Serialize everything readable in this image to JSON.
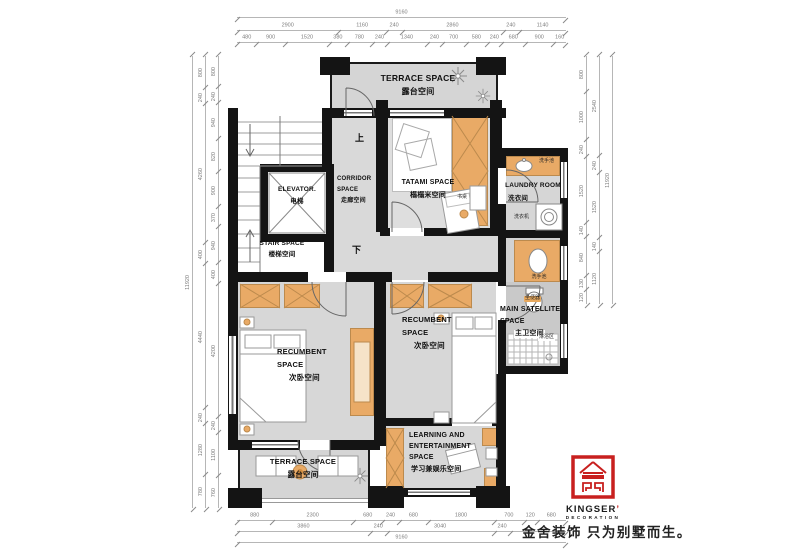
{
  "rooms": {
    "terrace_top": {
      "en": "TERRACE SPACE",
      "cn": "露台空间"
    },
    "corridor": {
      "en1": "CORRIDOR",
      "en2": "SPACE",
      "cn": "走廊空间"
    },
    "elevator": {
      "en": "ELEVATOR.",
      "cn": "电梯"
    },
    "stair": {
      "en": "STAIR SPACE",
      "cn": "楼梯空间"
    },
    "tatami": {
      "en": "TATAMI SPACE",
      "cn": "榻榻米空间"
    },
    "laundry": {
      "en": "LAUNDRY ROOM",
      "cn": "洗衣间"
    },
    "main_bath": {
      "en1": "MAIN SATELLITE",
      "en2": "SPACE",
      "cn": "主卫空间"
    },
    "bed_left": {
      "en1": "RECUMBENT",
      "en2": "SPACE",
      "cn": "次卧空间"
    },
    "bed_right": {
      "en1": "RECUMBENT",
      "en2": "SPACE",
      "cn": "次卧空间"
    },
    "learning": {
      "en1": "LEARNING AND",
      "en2": "ENTERTAINMENT",
      "en3": "SPACE",
      "cn": "学习兼娱乐空间"
    },
    "terrace_bottom": {
      "en": "TERRACE SPACE",
      "cn": "露台空间"
    }
  },
  "annotations": {
    "up": "上",
    "down": "下",
    "basin_laundry": "洗手池",
    "basin_bath": "洗手池",
    "washer": "洗衣机",
    "toilet": "坐便器",
    "shower": "淋浴区",
    "desk": "书桌"
  },
  "logo": {
    "brand": "KINGSER",
    "mark": "’",
    "sub": "DECORATION",
    "tagline": "金舍装饰 只为别墅而生。",
    "red": "#c8201f"
  },
  "colors": {
    "wall": "#141414",
    "floor": "#d8d8d8",
    "furniture": "#e9aa66",
    "logo_red": "#c8201f"
  },
  "dimensions": {
    "top_total": {
      "labels": [
        "9160"
      ],
      "weights": [
        1
      ]
    },
    "top_row2": {
      "labels": [
        "2900",
        "1160",
        "240",
        "2860",
        "240",
        "1140"
      ],
      "weights": [
        2900,
        1160,
        240,
        2860,
        240,
        1140
      ]
    },
    "top_row3": {
      "labels": [
        "480",
        "900",
        "1520",
        "380",
        "780",
        "240",
        "1340",
        "240",
        "700",
        "580",
        "240",
        "680",
        "900",
        "160"
      ],
      "weights": [
        480,
        900,
        1520,
        380,
        780,
        240,
        1340,
        240,
        700,
        580,
        240,
        680,
        900,
        160
      ]
    },
    "bottom_row1": {
      "labels": [
        "880",
        "2300",
        "680",
        "240",
        "680",
        "1800",
        "700",
        "120",
        "680"
      ],
      "weights": [
        880,
        2300,
        680,
        240,
        680,
        1800,
        700,
        120,
        680
      ]
    },
    "bottom_row2": {
      "labels": [
        "3860",
        "240",
        "3040",
        "240",
        ""
      ],
      "weights": [
        3860,
        240,
        3040,
        240,
        1780
      ]
    },
    "bottom_total": {
      "labels": [
        "9160"
      ],
      "weights": [
        1
      ]
    },
    "left_total": {
      "labels": [
        "11920"
      ],
      "weights": [
        1
      ]
    },
    "left_outer": {
      "labels": [
        "800",
        "240",
        "4260",
        "400",
        "4440",
        "240",
        "1280",
        "780"
      ],
      "weights": [
        800,
        240,
        4260,
        400,
        4440,
        240,
        1280,
        780
      ]
    },
    "left_inner": {
      "labels": [
        "800",
        "240",
        "940",
        "820",
        "900",
        "370",
        "940",
        "400",
        "4200",
        "240",
        "1100",
        "760"
      ],
      "weights": [
        800,
        240,
        940,
        820,
        900,
        370,
        940,
        400,
        4200,
        240,
        1100,
        760
      ]
    },
    "right_inner": {
      "labels": [
        "800",
        "1000",
        "240",
        "1520",
        "140",
        "840",
        "130",
        "120"
      ],
      "weights": [
        800,
        1000,
        240,
        1520,
        140,
        840,
        130,
        120
      ]
    },
    "right_mid": {
      "labels": [
        "2540",
        "240",
        "1520",
        "140",
        "1120"
      ],
      "weights": [
        2540,
        240,
        1520,
        140,
        1120
      ]
    },
    "right_total": {
      "labels": [
        "11920"
      ],
      "weights": [
        1
      ]
    }
  }
}
